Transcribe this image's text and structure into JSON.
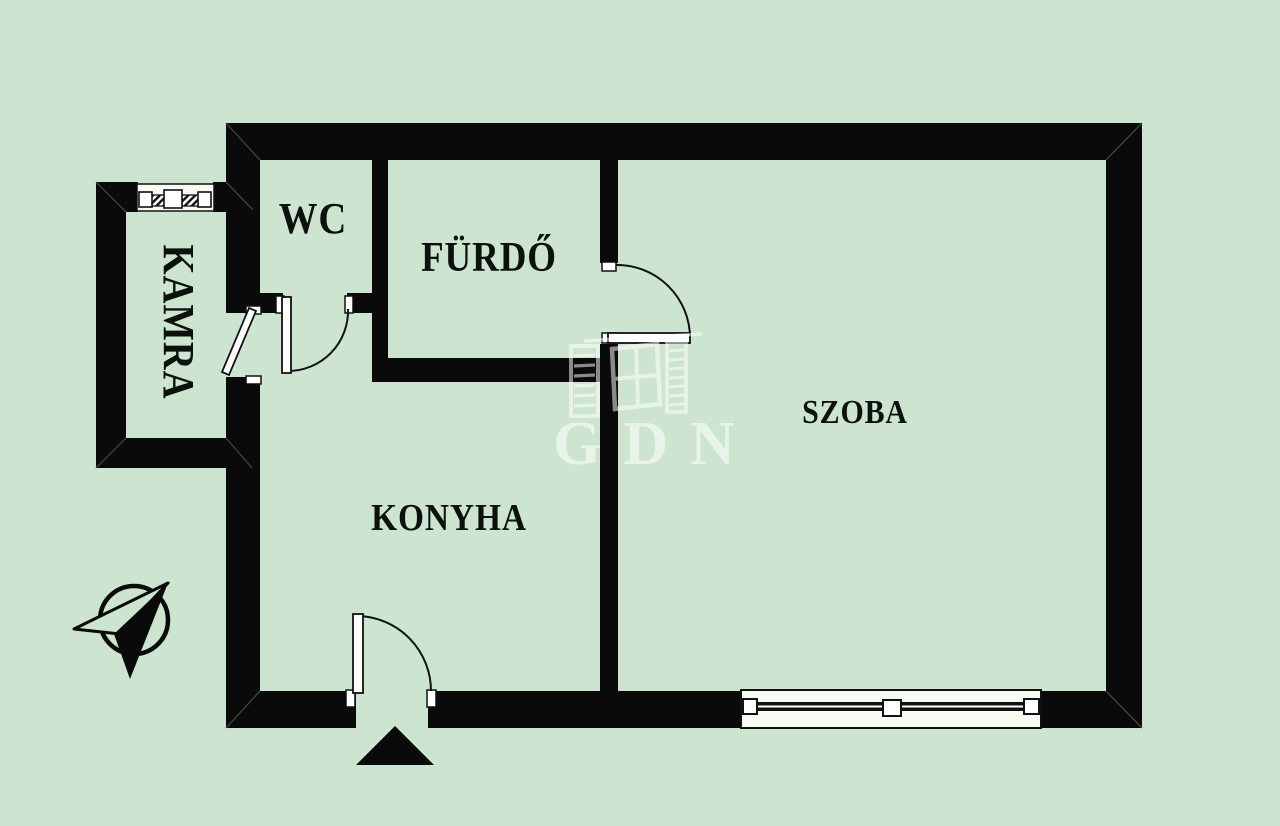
{
  "plan": {
    "rooms": [
      {
        "id": "wc",
        "label": "WC"
      },
      {
        "id": "furdo",
        "label": "FÜRDŐ"
      },
      {
        "id": "kamra",
        "label": "KAMRA"
      },
      {
        "id": "konyha",
        "label": "KONYHA"
      },
      {
        "id": "szoba",
        "label": "SZOBA"
      }
    ],
    "watermark": {
      "text": "GDN"
    },
    "symbols": [
      {
        "name": "north-arrow-compass"
      },
      {
        "name": "entrance-triangle-marker"
      },
      {
        "name": "window-szoba"
      },
      {
        "name": "window-kamra"
      },
      {
        "name": "door-wc"
      },
      {
        "name": "door-kamra"
      },
      {
        "name": "door-furdo-szoba"
      },
      {
        "name": "door-entrance"
      }
    ],
    "colors": {
      "background": "#cde4d1",
      "wall": "#0a0a0a",
      "door_leaf": "#ffffff",
      "watermark": "rgba(255,255,255,0.55)"
    }
  }
}
